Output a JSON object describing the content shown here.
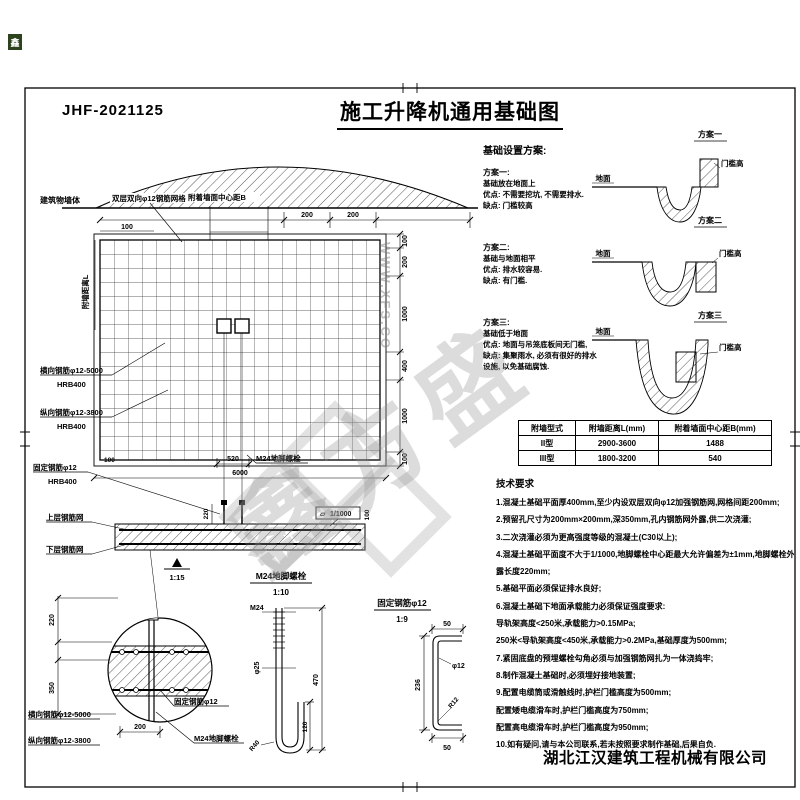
{
  "meta": {
    "drawing_no": "JHF-2021125",
    "title": "施工升降机通用基础图",
    "company": "湖北江汉建筑工程机械有限公司",
    "stamp": "鑫"
  },
  "watermark": {
    "brand": "鑫方盛",
    "site": "WWW.XFS.CO"
  },
  "plan": {
    "wall_label": "建筑物墙体",
    "mesh_label": "双层双向φ12钢筋网格",
    "center_b_label": "附着墙面中心距B",
    "wall_dist_label": "附墙距离L",
    "anchor_label": "M24地脚螺栓",
    "rebar_h_label": "横向钢筋φ12-5000",
    "rebar_h_grade": "HRB400",
    "rebar_v_label": "纵向钢筋φ12-3800",
    "rebar_v_grade": "HRB400",
    "rebar_f_label": "固定钢筋φ12",
    "rebar_f_grade": "HRB400",
    "dims": {
      "top_offset": "100",
      "top_a": "200",
      "top_b": "200",
      "right": [
        "100",
        "200",
        "1000",
        "400",
        "1000",
        "100"
      ],
      "bolt_span": "520",
      "overall": "6000",
      "left_edge": "100"
    }
  },
  "section": {
    "upper_label": "上层钢筋网",
    "lower_label": "下层钢筋网",
    "protrude_dim": "220",
    "flatness_symbol": "▱",
    "flatness_value": "1/1000",
    "flatness_dim": "100",
    "scale": "1:15"
  },
  "detail_corner": {
    "dim_220": "220",
    "dim_350": "350",
    "dim_200": "200",
    "label_h": "横向钢筋φ12-5000",
    "label_v": "纵向钢筋φ12-3800",
    "label_f": "固定钢筋φ12",
    "label_anchor": "M24地脚螺栓"
  },
  "detail_bolt": {
    "title": "M24地脚螺栓",
    "scale": "1:10",
    "thread": "M24",
    "dia": "φ25",
    "height": "470",
    "hook": "120",
    "radius": "R40"
  },
  "detail_fix": {
    "title": "固定钢筋φ12",
    "scale": "1:9",
    "top_len": "50",
    "dia": "φ12",
    "height": "236",
    "radius": "R12",
    "bottom_len": "50"
  },
  "schemes": {
    "heading": "基础设置方案:",
    "items": [
      {
        "title": "方案一:",
        "lines": [
          "基础放在地面上",
          "优点: 不需要挖坑, 不需要排水.",
          "缺点: 门槛较高"
        ]
      },
      {
        "title": "方案二:",
        "lines": [
          "基础与地面相平",
          "优点: 排水较容易.",
          "缺点: 有门槛."
        ]
      },
      {
        "title": "方案三:",
        "lines": [
          "基础低于地面",
          "优点: 地面与吊笼底板间无门槛,",
          "缺点: 集聚雨水, 必须有很好的排水",
          "设施, 以免基础腐蚀."
        ]
      }
    ],
    "sketch_titles": [
      "方案一",
      "方案二",
      "方案三"
    ],
    "ground_label": "地面",
    "sill_label": "门槛高"
  },
  "table": {
    "headers": [
      "附墙型式",
      "附墙距离L(mm)",
      "附着墙面中心距B(mm)"
    ],
    "rows": [
      [
        "II型",
        "2900-3600",
        "1488"
      ],
      [
        "III型",
        "1800-3200",
        "540"
      ]
    ]
  },
  "tech": {
    "heading": "技术要求",
    "lines": [
      "1.混凝土基础平面厚400mm,至少内设双层双向φ12加强钢筋网,网格间距200mm;",
      "2.预留孔尺寸为200mm×200mm,深350mm,孔内钢筋网外露,供二次浇灌;",
      "3.二次浇灌必须为更高强度等级的混凝土(C30以上);",
      "4.混凝土基础平面度不大于1/1000,地脚螺栓中心距最大允许偏差为±1mm,地脚螺栓外",
      "露长度220mm;",
      "5.基础平面必须保证排水良好;",
      "6.混凝土基础下地面承载能力必须保证强度要求:",
      "导轨架高度<250米,承载能力>0.15MPa;",
      "250米<导轨架高度<450米,承载能力>0.2MPa,基础厚度为500mm;",
      "7.紧固底盘的预埋螺栓勾角必须与加强钢筋网扎为一体浇捣牢;",
      "8.制作混凝土基础时,必须埋好接地装置;",
      "9.配置电缆筒或滑触线时,护栏门槛高度为500mm;",
      "配置矮电缆滑车时,护栏门槛高度为750mm;",
      "配置高电缆滑车时,护栏门槛高度为950mm;",
      "10.如有疑问,请与本公司联系,若未按照要求制作基础,后果自负."
    ]
  }
}
